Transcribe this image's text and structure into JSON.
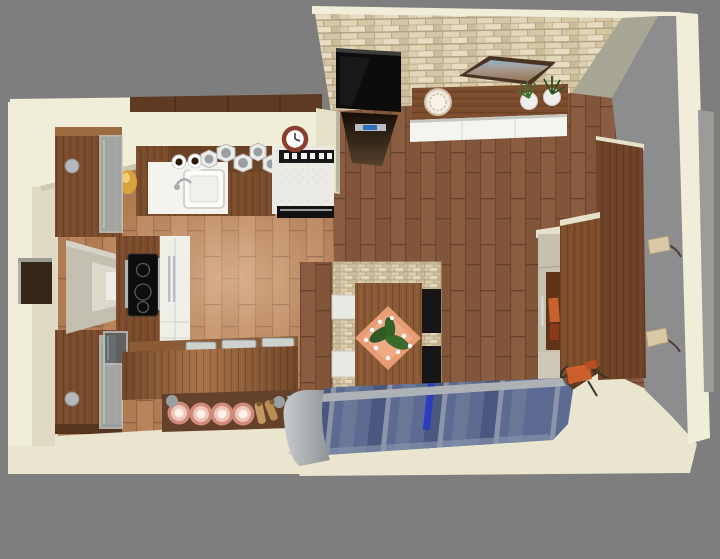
{
  "scene": {
    "type": "3d-interior-render",
    "view": "top-down birds-eye 3D render",
    "description": "3D rendering of an open-plan kitchen and living-dining room seen from above, surrounded by a gray backdrop",
    "rooms": [
      "kitchen",
      "living-dining-room"
    ],
    "objects": [
      "stone-accent-wall",
      "wall-tv",
      "glass-hood-fireplace",
      "art-frame",
      "floating-shelf",
      "decorative-plate",
      "potted-plant",
      "white-sideboard",
      "upper-cabinets",
      "wall-clock",
      "coffee-cups",
      "storage-canisters",
      "kitchen-sink",
      "faucet",
      "fruit-bowl",
      "range-cooker",
      "display-cabinet",
      "wall-window-reveal",
      "wall-panel",
      "island-cooktop",
      "tall-white-cabinet",
      "glass-mini-cabinet",
      "breakfast-bar",
      "serving-trays",
      "pendant-lights",
      "pepper-mills",
      "stool-knobs",
      "dining-stone-pillar",
      "dining-table",
      "placemat",
      "table-plant",
      "white-chair",
      "black-chair",
      "blue-striped-sofa",
      "sofa-arm",
      "tall-beige-cabinet",
      "wardrobe",
      "open-wardrobe-door",
      "accent-chair",
      "wall-sconce",
      "room-walls",
      "kitchen-floor",
      "living-floor"
    ]
  },
  "palette": {
    "bg": "#7e7e7e",
    "wallTop": "#f0edd8",
    "wallInner": "#dfdac1",
    "wallBottom": "#e9e5cf",
    "sage": "#a8a795",
    "grayWall": "#8d8d8f",
    "grayWallLight": "#9b9b97",
    "stoneBase": "#cfc0a0",
    "livingFloor": "#8a5c40",
    "kitchenFloor": "#b9845c",
    "walnut": "#7b4c2c",
    "walnutDark": "#5f3a22",
    "walnutLight": "#9c6b40",
    "tvBlack": "#0c0c0c",
    "cooktopBlack": "#0d0d0d",
    "whiteUnit": "#f0efe8",
    "sideboardWhite": "#f4f4f0",
    "sofaBlue": "#5d6b92",
    "sofaBlueDark": "#4b577e",
    "silver": "#aeb2b6",
    "pendantCopper": "#cf8a7c",
    "placematOrange": "#e79c74",
    "accentChair": "#cc5e2c",
    "beigeUnit": "#c6c0ae",
    "accentBlue": "#2438c8",
    "clockRing": "#8a4030",
    "plantGreen": "#3f6f2d",
    "sconceShade": "#d9c9a6"
  }
}
